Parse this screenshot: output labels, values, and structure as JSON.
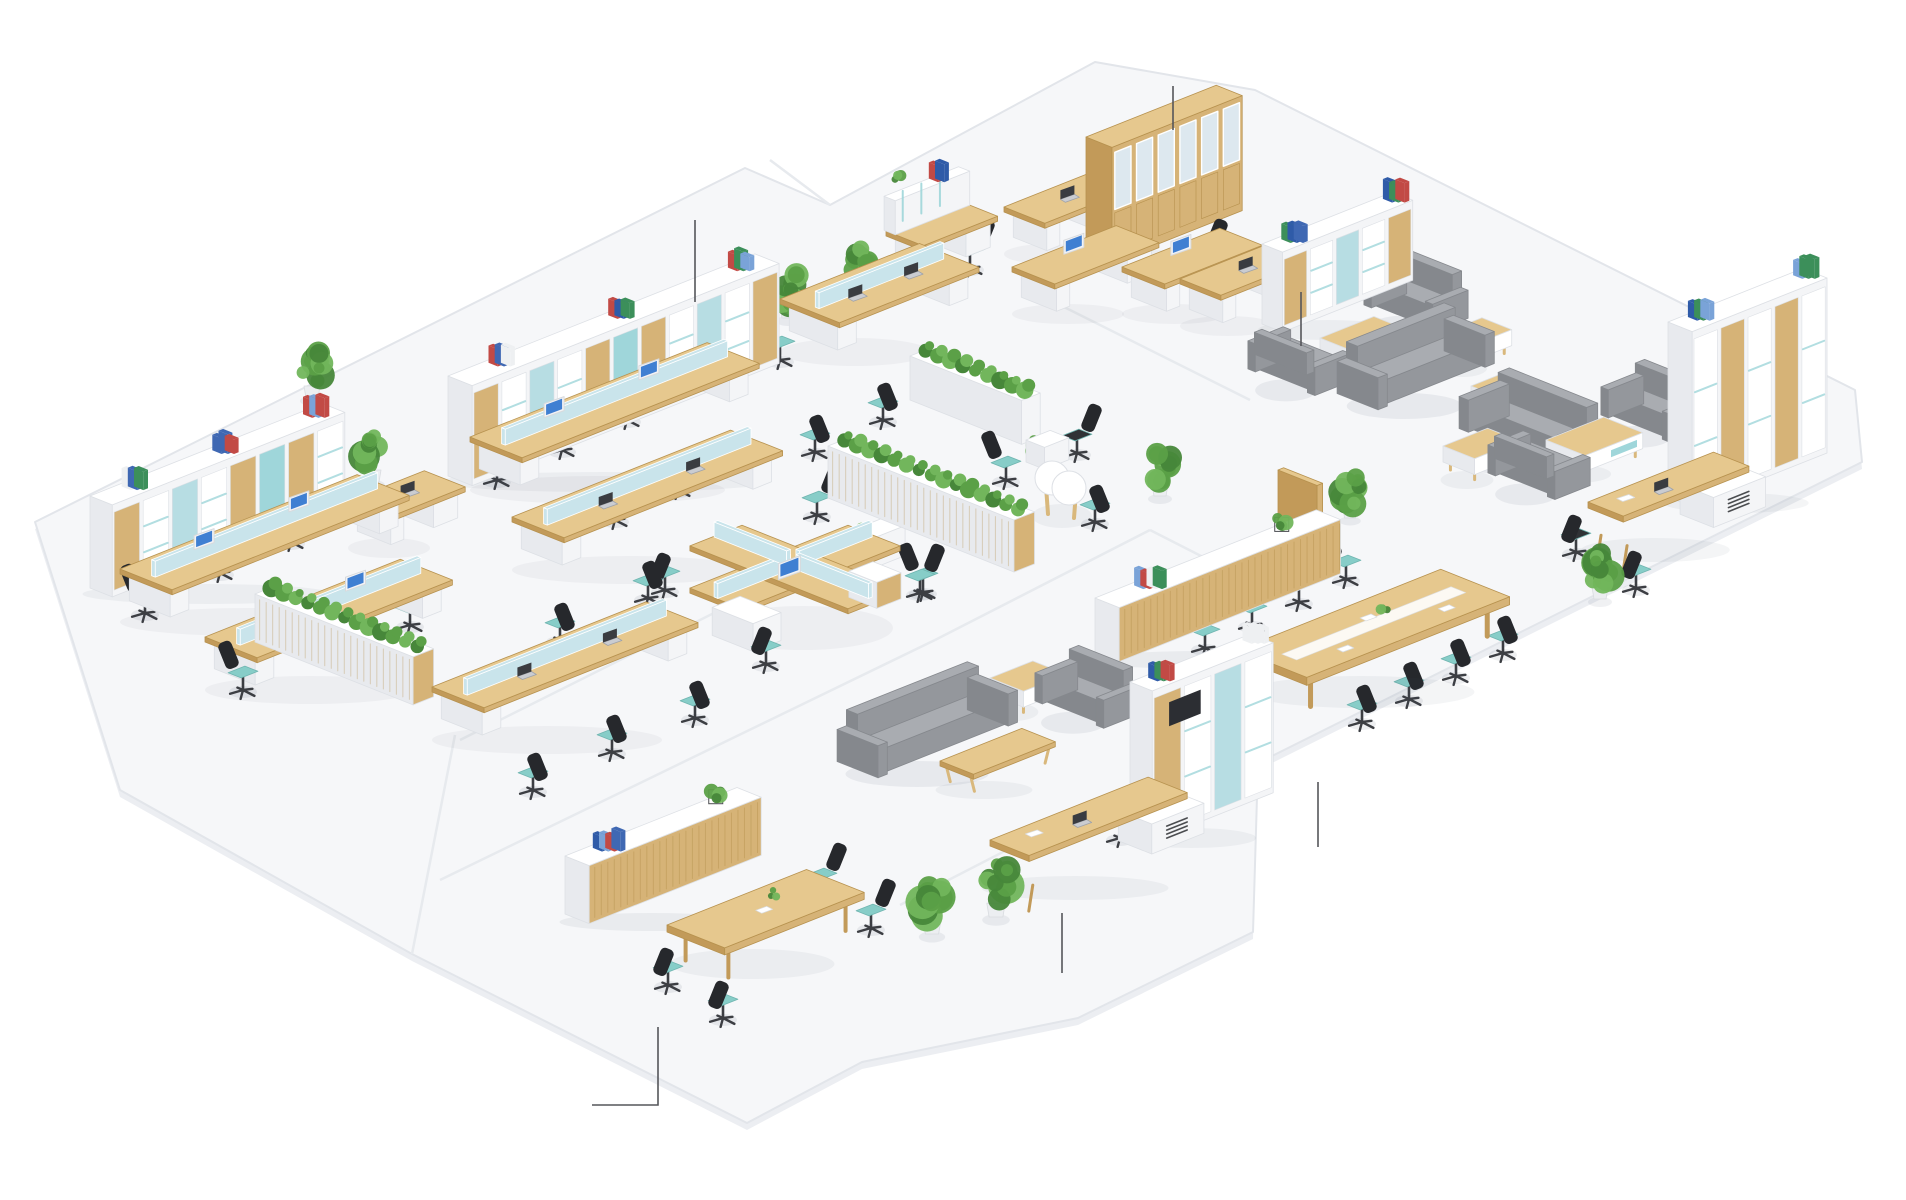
{
  "meta": {
    "description": "isometric-office-floorplan-render",
    "width": 1906,
    "height": 1200
  },
  "palette": {
    "background": "#ffffff",
    "floor": "#f6f7f9",
    "floor_edge": "#e2e5ea",
    "floor_side": "#eceef2",
    "seam": "#e7eaee",
    "wood_top": "#e6c88e",
    "wood_front": "#d6b377",
    "wood_side": "#c29a59",
    "wood_line": "#b7924f",
    "white_top": "#ffffff",
    "white_front": "#f4f5f7",
    "white_side": "#e8eaee",
    "white_line": "#dde0e5",
    "teal_seat": "#87cdc8",
    "teal_accent": "#9fd6da",
    "pale_screen": "#c9e4eb",
    "blue_panel": "#b7dde3",
    "chair_dark": "#26282c",
    "chair_leg": "#3c3e43",
    "sofa_top": "#a9acb1",
    "sofa_front": "#94979c",
    "sofa_side": "#85888d",
    "green_dark": "#47873a",
    "green_mid": "#5ba047",
    "green_light": "#72b65c",
    "glass": "#dde8ef",
    "screen_blue": "#3f7fd2",
    "leader": "#55565a",
    "binders": [
      "#3f68b3",
      "#2f5ba8",
      "#c24a45",
      "#3c8f5a",
      "#eef0f2",
      "#7aa3d8"
    ]
  },
  "floor": {
    "outline": [
      [
        35,
        522
      ],
      [
        745,
        168
      ],
      [
        830,
        205
      ],
      [
        1095,
        62
      ],
      [
        1255,
        90
      ],
      [
        1855,
        390
      ],
      [
        1862,
        462
      ],
      [
        1258,
        763
      ],
      [
        1253,
        932
      ],
      [
        1078,
        1018
      ],
      [
        862,
        1062
      ],
      [
        747,
        1123
      ],
      [
        412,
        954
      ],
      [
        120,
        790
      ]
    ],
    "seams": [
      [
        [
          460,
          740
        ],
        [
          830,
          555
        ]
      ],
      [
        [
          440,
          880
        ],
        [
          935,
          640
        ]
      ],
      [
        [
          935,
          640
        ],
        [
          1150,
          530
        ]
      ],
      [
        [
          1040,
          295
        ],
        [
          1250,
          400
        ]
      ],
      [
        [
          900,
          905
        ],
        [
          1065,
          820
        ]
      ],
      [
        [
          1150,
          530
        ],
        [
          1258,
          585
        ]
      ],
      [
        [
          770,
          160
        ],
        [
          830,
          205
        ]
      ],
      [
        [
          412,
          954
        ],
        [
          455,
          735
        ]
      ]
    ]
  },
  "callouts": [
    {
      "name": "callout-storage-wall",
      "points": [
        [
          695,
          220
        ],
        [
          695,
          302
        ]
      ]
    },
    {
      "name": "callout-glass-cabinet",
      "points": [
        [
          1173,
          86
        ],
        [
          1173,
          130
        ]
      ]
    },
    {
      "name": "callout-lounge-shelf",
      "points": [
        [
          1301,
          292
        ],
        [
          1301,
          346
        ]
      ]
    },
    {
      "name": "callout-conference-floor",
      "points": [
        [
          1318,
          782
        ],
        [
          1318,
          847
        ]
      ]
    },
    {
      "name": "callout-executive-desk",
      "points": [
        [
          1062,
          913
        ],
        [
          1062,
          973
        ]
      ]
    },
    {
      "name": "callout-meeting-area",
      "points": [
        [
          592,
          1105
        ],
        [
          658,
          1105
        ],
        [
          658,
          1027
        ]
      ]
    }
  ],
  "items": [
    {
      "type": "shelf",
      "name": "storage-wall-a",
      "x": 448,
      "y": 476,
      "a": 330,
      "b": 26,
      "h": 100,
      "style": "mixed"
    },
    {
      "type": "shelf",
      "name": "storage-wall-b",
      "x": 90,
      "y": 588,
      "a": 250,
      "b": 24,
      "h": 92,
      "style": "mixed"
    },
    {
      "type": "shelf",
      "name": "lounge-shelf-d",
      "x": 1262,
      "y": 324,
      "a": 140,
      "b": 22,
      "h": 80,
      "style": "mixed"
    },
    {
      "type": "shelf",
      "name": "bookshelf-tall-e",
      "x": 1668,
      "y": 497,
      "a": 145,
      "b": 26,
      "h": 175,
      "style": "tall"
    },
    {
      "type": "shelf",
      "name": "bookshelf-tv-h",
      "x": 1130,
      "y": 832,
      "a": 130,
      "b": 24,
      "h": 150,
      "style": "tv"
    },
    {
      "type": "glass_cabinet",
      "name": "glass-cabinet",
      "x": 1086,
      "y": 252,
      "a": 140,
      "b": 28,
      "h": 115
    },
    {
      "type": "credenza",
      "name": "conference-credenza",
      "x": 1095,
      "y": 652,
      "a": 238,
      "b": 26,
      "h": 54,
      "binders": 0.16,
      "plant": 0.8
    },
    {
      "type": "credenza",
      "name": "reception-credenza",
      "x": 565,
      "y": 914,
      "a": 185,
      "b": 26,
      "h": 58,
      "binders": 0.14,
      "plant": 0.82
    },
    {
      "type": "planter",
      "name": "planter-wall-1",
      "x": 828,
      "y": 498,
      "a": 22,
      "b": 200,
      "h": 52,
      "wood": true
    },
    {
      "type": "planter",
      "name": "planter-wall-2",
      "x": 910,
      "y": 400,
      "a": 20,
      "b": 120,
      "h": 44,
      "wood": false
    },
    {
      "type": "planter",
      "name": "planter-wall-3",
      "x": 255,
      "y": 642,
      "a": 22,
      "b": 170,
      "h": 48,
      "wood": true
    },
    {
      "type": "divider",
      "name": "wood-divider",
      "x": 1278,
      "y": 526,
      "a": 6,
      "b": 42,
      "h": 56
    },
    {
      "type": "bench",
      "name": "bench-desks-1",
      "x": 470,
      "y": 468,
      "a": 255,
      "b": 56,
      "mon": "imac"
    },
    {
      "type": "bench",
      "name": "bench-desks-2",
      "x": 512,
      "y": 548,
      "a": 235,
      "b": 56,
      "mon": "laptop"
    },
    {
      "type": "bench",
      "name": "bench-desks-3",
      "x": 120,
      "y": 600,
      "a": 255,
      "b": 56,
      "mon": "imac"
    },
    {
      "type": "bench",
      "name": "bench-desks-4",
      "x": 205,
      "y": 668,
      "a": 210,
      "b": 56,
      "mon": "imac"
    },
    {
      "type": "bench",
      "name": "bench-desks-5",
      "x": 432,
      "y": 718,
      "a": 230,
      "b": 56,
      "mon": "laptop"
    },
    {
      "type": "bench",
      "name": "bench-desks-6",
      "x": 780,
      "y": 330,
      "a": 150,
      "b": 64,
      "mon": "laptop"
    },
    {
      "type": "pod4",
      "name": "cross-workstation-pod",
      "x": 795,
      "y": 598
    },
    {
      "type": "desk",
      "name": "desk-l-16",
      "x": 1004,
      "y": 238,
      "a": 90,
      "b": 44,
      "mon": "laptop"
    },
    {
      "type": "desk",
      "name": "desk-d1",
      "x": 1012,
      "y": 298,
      "a": 112,
      "b": 46,
      "mon": "imac"
    },
    {
      "type": "desk",
      "name": "desk-d2",
      "x": 1122,
      "y": 298,
      "a": 105,
      "b": 46,
      "mon": "imac"
    },
    {
      "type": "desk",
      "name": "desk-lounge-corner",
      "x": 1180,
      "y": 310,
      "a": 95,
      "b": 44,
      "mon": "laptop"
    },
    {
      "type": "desk",
      "name": "desk-l-13",
      "x": 348,
      "y": 532,
      "a": 82,
      "b": 44,
      "mon": "laptop"
    },
    {
      "type": "desk",
      "name": "reception-hutch-desk",
      "x": 886,
      "y": 262,
      "a": 80,
      "b": 40,
      "mon": "none",
      "hutch": true
    },
    {
      "type": "exec_desk",
      "name": "executive-desk-i",
      "x": 990,
      "y": 874,
      "a": 170,
      "b": 60
    },
    {
      "type": "exec_desk",
      "name": "executive-desk-f",
      "x": 1588,
      "y": 536,
      "a": 135,
      "b": 56
    },
    {
      "type": "conf_table",
      "name": "conference-table",
      "x": 1238,
      "y": 688,
      "a": 218,
      "b": 74
    },
    {
      "type": "meeting_table",
      "name": "meeting-table",
      "x": 667,
      "y": 962,
      "a": 150,
      "b": 62
    },
    {
      "type": "peanut",
      "name": "round-meeting-table",
      "x": 1058,
      "y": 500
    },
    {
      "type": "sofa",
      "name": "sofa-lounge-top",
      "x": 1352,
      "y": 392,
      "len": 105,
      "face": "se"
    },
    {
      "type": "sofa",
      "name": "sofa-lounge-right",
      "x": 1474,
      "y": 430,
      "len": 95,
      "face": "sw"
    },
    {
      "type": "sofa",
      "name": "sofa-lounge-center",
      "x": 852,
      "y": 760,
      "len": 130,
      "face": "se"
    },
    {
      "type": "armchair",
      "name": "armchair-1",
      "x": 1376,
      "y": 306,
      "len": 58,
      "face": "sw"
    },
    {
      "type": "armchair",
      "name": "armchair-2",
      "x": 1260,
      "y": 370,
      "len": 56,
      "face": "ne"
    },
    {
      "type": "armchair",
      "name": "armchair-3",
      "x": 1613,
      "y": 416,
      "len": 58,
      "face": "sw"
    },
    {
      "type": "armchair",
      "name": "armchair-4",
      "x": 1500,
      "y": 474,
      "len": 56,
      "face": "ne"
    },
    {
      "type": "armchair",
      "name": "armchair-5",
      "x": 1047,
      "y": 702,
      "len": 58,
      "face": "sw"
    },
    {
      "type": "coffee",
      "name": "coffee-table-1",
      "x": 1320,
      "y": 362,
      "a": 58,
      "b": 38,
      "h": 30
    },
    {
      "type": "coffee",
      "name": "coffee-table-2",
      "x": 1441,
      "y": 358,
      "a": 44,
      "b": 32,
      "h": 28
    },
    {
      "type": "coffee",
      "name": "coffee-table-3",
      "x": 1443,
      "y": 470,
      "a": 48,
      "b": 34,
      "h": 28
    },
    {
      "type": "coffee",
      "name": "coffee-table-4",
      "x": 1546,
      "y": 464,
      "a": 62,
      "b": 42,
      "h": 30,
      "teal": true
    },
    {
      "type": "coffee",
      "name": "side-table-1",
      "x": 1471,
      "y": 410,
      "a": 38,
      "b": 30,
      "h": 26
    },
    {
      "type": "coffee",
      "name": "side-table-2",
      "x": 990,
      "y": 702,
      "a": 46,
      "b": 36,
      "h": 30,
      "teal": true
    },
    {
      "type": "bench_table",
      "name": "wood-bench-table",
      "x": 940,
      "y": 782,
      "a": 88,
      "b": 36
    },
    {
      "type": "box",
      "name": "white-cabinet-1",
      "x": 853,
      "y": 560,
      "a": 34,
      "b": 22,
      "h": 30
    },
    {
      "type": "box",
      "name": "white-cabinet-2",
      "x": 1026,
      "y": 462,
      "a": 26,
      "b": 20,
      "h": 22
    },
    {
      "type": "plant",
      "name": "plant",
      "x": 312,
      "y": 398,
      "s": 1.0
    },
    {
      "type": "plant",
      "name": "plant",
      "x": 373,
      "y": 482,
      "s": 1.0
    },
    {
      "type": "plant",
      "name": "plant",
      "x": 788,
      "y": 318,
      "s": 1.0
    },
    {
      "type": "plant",
      "name": "plant",
      "x": 860,
      "y": 290,
      "s": 0.9
    },
    {
      "type": "plant",
      "name": "plant",
      "x": 1160,
      "y": 496,
      "s": 1.0
    },
    {
      "type": "plant",
      "name": "plant",
      "x": 1350,
      "y": 518,
      "s": 0.9
    },
    {
      "type": "plant",
      "name": "plant",
      "x": 1600,
      "y": 599,
      "s": 1.0
    },
    {
      "type": "plant",
      "name": "plant",
      "x": 996,
      "y": 917,
      "s": 1.15
    },
    {
      "type": "plant",
      "name": "plant",
      "x": 932,
      "y": 934,
      "s": 1.1
    },
    {
      "type": "plant",
      "name": "plant",
      "x": 862,
      "y": 551,
      "s": 0.5
    },
    {
      "type": "plant",
      "name": "plant",
      "x": 1036,
      "y": 460,
      "s": 0.5
    },
    {
      "type": "chair",
      "name": "office-chair",
      "x": 497,
      "y": 480,
      "face": "se"
    },
    {
      "type": "chair",
      "name": "office-chair",
      "x": 562,
      "y": 450,
      "face": "se"
    },
    {
      "type": "chair",
      "name": "office-chair",
      "x": 627,
      "y": 420,
      "face": "se"
    },
    {
      "type": "chair",
      "name": "office-chair",
      "x": 615,
      "y": 520,
      "face": "nw"
    },
    {
      "type": "chair",
      "name": "office-chair",
      "x": 678,
      "y": 490,
      "face": "nw"
    },
    {
      "type": "chair",
      "name": "office-chair",
      "x": 560,
      "y": 640,
      "face": "nw"
    },
    {
      "type": "chair",
      "name": "office-chair",
      "x": 648,
      "y": 598,
      "face": "nw"
    },
    {
      "type": "chair",
      "name": "office-chair",
      "x": 145,
      "y": 613,
      "face": "se"
    },
    {
      "type": "chair",
      "name": "office-chair",
      "x": 220,
      "y": 573,
      "face": "se"
    },
    {
      "type": "chair",
      "name": "office-chair",
      "x": 291,
      "y": 542,
      "face": "se"
    },
    {
      "type": "chair",
      "name": "office-chair",
      "x": 243,
      "y": 690,
      "face": "se"
    },
    {
      "type": "chair",
      "name": "office-chair",
      "x": 331,
      "y": 655,
      "face": "se"
    },
    {
      "type": "chair",
      "name": "office-chair",
      "x": 410,
      "y": 625,
      "face": "se"
    },
    {
      "type": "chair",
      "name": "office-chair",
      "x": 533,
      "y": 790,
      "face": "nw"
    },
    {
      "type": "chair",
      "name": "office-chair",
      "x": 612,
      "y": 752,
      "face": "nw"
    },
    {
      "type": "chair",
      "name": "office-chair",
      "x": 695,
      "y": 718,
      "face": "nw"
    },
    {
      "type": "chair",
      "name": "office-chair",
      "x": 780,
      "y": 360,
      "face": "se"
    },
    {
      "type": "chair",
      "name": "office-chair",
      "x": 835,
      "y": 334,
      "face": "se"
    },
    {
      "type": "chair",
      "name": "office-chair",
      "x": 883,
      "y": 420,
      "face": "nw"
    },
    {
      "type": "chair",
      "name": "office-chair",
      "x": 815,
      "y": 452,
      "face": "nw"
    },
    {
      "type": "chair",
      "name": "office-chair",
      "x": 817,
      "y": 515,
      "face": "sw"
    },
    {
      "type": "chair",
      "name": "office-chair",
      "x": 665,
      "y": 590,
      "face": "ne"
    },
    {
      "type": "chair",
      "name": "office-chair",
      "x": 920,
      "y": 593,
      "face": "sw"
    },
    {
      "type": "chair",
      "name": "office-chair",
      "x": 766,
      "y": 664,
      "face": "ne"
    },
    {
      "type": "chair",
      "name": "office-chair",
      "x": 923,
      "y": 592,
      "face": "se"
    },
    {
      "type": "chair",
      "name": "office-chair",
      "x": 1077,
      "y": 453,
      "face": "sw",
      "seat": "black"
    },
    {
      "type": "chair",
      "name": "office-chair",
      "x": 1095,
      "y": 522,
      "face": "nw"
    },
    {
      "type": "chair",
      "name": "office-chair",
      "x": 1006,
      "y": 480,
      "face": "se"
    },
    {
      "type": "chair",
      "name": "office-chair",
      "x": 970,
      "y": 268,
      "face": "sw"
    },
    {
      "type": "chair",
      "name": "office-chair",
      "x": 1108,
      "y": 222,
      "face": "sw",
      "seat": "black"
    },
    {
      "type": "chair",
      "name": "office-chair",
      "x": 1203,
      "y": 268,
      "face": "sw"
    },
    {
      "type": "chair",
      "name": "office-chair",
      "x": 1293,
      "y": 300,
      "face": "sw",
      "seat": "black"
    },
    {
      "type": "chair",
      "name": "conference-chair",
      "x": 1205,
      "y": 648,
      "face": "se"
    },
    {
      "type": "chair",
      "name": "conference-chair",
      "x": 1252,
      "y": 625,
      "face": "se"
    },
    {
      "type": "chair",
      "name": "conference-chair",
      "x": 1299,
      "y": 602,
      "face": "se"
    },
    {
      "type": "chair",
      "name": "conference-chair",
      "x": 1346,
      "y": 579,
      "face": "se"
    },
    {
      "type": "chair",
      "name": "conference-chair",
      "x": 1362,
      "y": 722,
      "face": "nw"
    },
    {
      "type": "chair",
      "name": "conference-chair",
      "x": 1409,
      "y": 699,
      "face": "nw"
    },
    {
      "type": "chair",
      "name": "conference-chair",
      "x": 1456,
      "y": 676,
      "face": "nw"
    },
    {
      "type": "chair",
      "name": "conference-chair",
      "x": 1503,
      "y": 653,
      "face": "nw"
    },
    {
      "type": "chair",
      "name": "office-chair",
      "x": 1708,
      "y": 482,
      "face": "sw",
      "seat": "black"
    },
    {
      "type": "chair",
      "name": "guest-chair",
      "x": 1576,
      "y": 552,
      "face": "ne",
      "seat": "black"
    },
    {
      "type": "chair",
      "name": "guest-chair",
      "x": 1636,
      "y": 588,
      "face": "ne"
    },
    {
      "type": "chair",
      "name": "office-chair",
      "x": 1120,
      "y": 838,
      "face": "sw",
      "seat": "black"
    },
    {
      "type": "chair",
      "name": "meeting-chair",
      "x": 822,
      "y": 892,
      "face": "sw"
    },
    {
      "type": "chair",
      "name": "meeting-chair",
      "x": 871,
      "y": 928,
      "face": "sw"
    },
    {
      "type": "chair",
      "name": "meeting-chair",
      "x": 668,
      "y": 985,
      "face": "ne"
    },
    {
      "type": "chair",
      "name": "meeting-chair",
      "x": 723,
      "y": 1018,
      "face": "ne"
    }
  ]
}
